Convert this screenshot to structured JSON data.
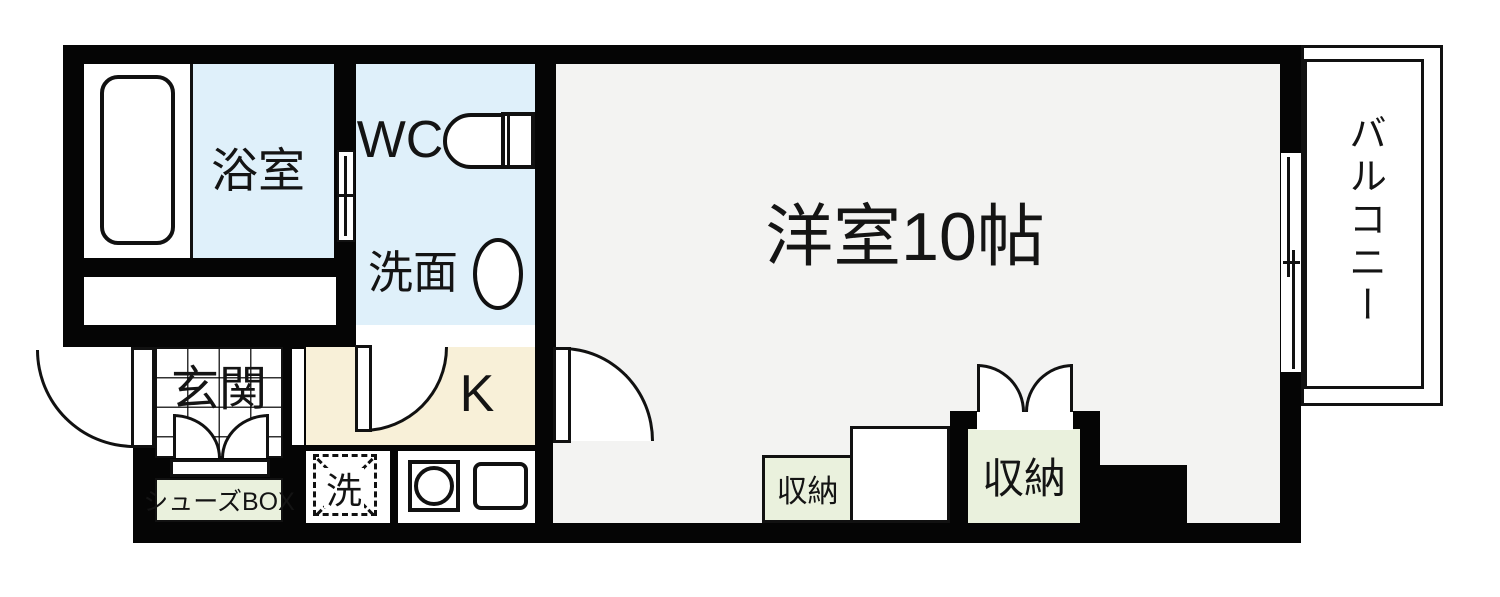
{
  "title": "1R apartment floor plan",
  "rooms": {
    "bathroom": {
      "label": "浴室"
    },
    "toilet": {
      "label": "WC"
    },
    "washroom": {
      "label": "洗面"
    },
    "entrance": {
      "label": "玄関"
    },
    "kitchen": {
      "label": "K"
    },
    "main_room": {
      "label": "洋室10帖"
    },
    "balcony": {
      "label": "バルコニー"
    },
    "shoes_box": {
      "label": "シューズBOX"
    },
    "laundry": {
      "label": "洗"
    },
    "storage_left": {
      "label": "収納"
    },
    "storage_right": {
      "label": "収納"
    }
  },
  "colors": {
    "wall": "#050505",
    "wet_area_blue": "#dff0fa",
    "kitchen_cream": "#f8f0d8",
    "storage_green": "#eaf1dd",
    "main_floor_gray": "#f3f3f2"
  }
}
